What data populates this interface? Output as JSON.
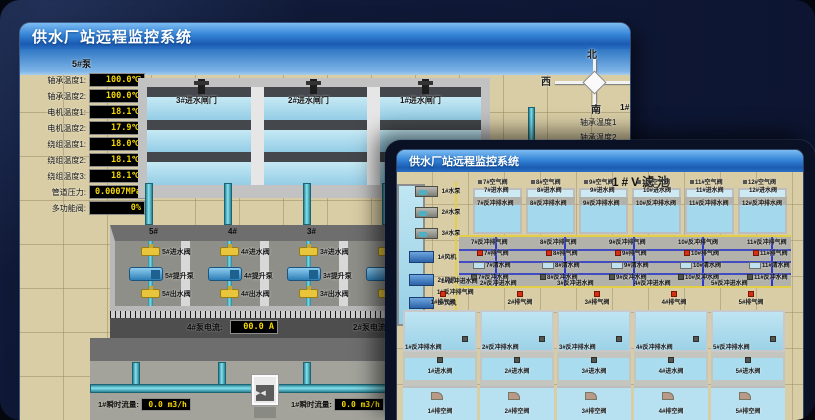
{
  "back": {
    "window_title": "供水厂站远程监控系统",
    "scene_title": "取水泵房",
    "panel_header": "5#泵",
    "sensors": [
      {
        "label": "轴承温度1:",
        "value": "100.0℃"
      },
      {
        "label": "轴承温度2:",
        "value": "100.0℃"
      },
      {
        "label": "电机温度1:",
        "value": "18.1℃"
      },
      {
        "label": "电机温度2:",
        "value": "17.9℃"
      },
      {
        "label": "绕组温度1:",
        "value": "18.0℃"
      },
      {
        "label": "绕组温度2:",
        "value": "18.1℃"
      },
      {
        "label": "绕组温度3:",
        "value": "18.1℃"
      },
      {
        "label": "管道压力:",
        "value": "0.0007MPa"
      },
      {
        "label": "多功能阀:",
        "value": "0%"
      }
    ],
    "gates": [
      "3#进水闸门",
      "2#进水闸门",
      "1#进水闸门"
    ],
    "compass": {
      "north": "北",
      "west": "西",
      "south": "南",
      "east": "东"
    },
    "right_panel": {
      "header": "1#泵",
      "rows": [
        "轴承温度1",
        "轴承温度2"
      ]
    },
    "bays": [
      {
        "no": "5#",
        "inlet": "5#进水阀",
        "pump": "5#提升泵",
        "outlet": "5#出水阀"
      },
      {
        "no": "4#",
        "inlet": "4#进水阀",
        "pump": "4#提升泵",
        "outlet": "4#出水阀"
      },
      {
        "no": "3#",
        "inlet": "3#进水阀",
        "pump": "3#提升泵",
        "outlet": "3#出水阀"
      },
      {
        "no": "2#",
        "inlet": "2#进水阀",
        "pump": "2#提升泵",
        "outlet": "2#出水阀"
      }
    ],
    "current_left": {
      "label": "4#泵电流:",
      "value": "00.0 A"
    },
    "current_right": {
      "label": "2#泵电流:"
    },
    "flows": [
      {
        "label": "1#瞬时流量:",
        "value": "0.0 m3/h"
      },
      {
        "label": "1#瞬时流量:",
        "value": "0.0 m3/h"
      }
    ]
  },
  "front": {
    "window_title": "供水厂站远程监控系统",
    "scene_title": "1#V滤池",
    "pumps": [
      "1#水泵",
      "2#水泵",
      "3#水泵"
    ],
    "fans": [
      "1#风机",
      "2#风机",
      "3#风机"
    ],
    "top_cells": [
      {
        "air": "7#空气阀",
        "inlet": "7#进水阀",
        "drain": "7#反冲排水阀"
      },
      {
        "air": "8#空气阀",
        "inlet": "8#进水阀",
        "drain": "8#反冲排水阀"
      },
      {
        "air": "9#空气阀",
        "inlet": "9#进水阀",
        "drain": "9#反冲排水阀"
      },
      {
        "air": "10#空气阀",
        "inlet": "10#进水阀",
        "drain": "10#反冲排水阀"
      },
      {
        "air": "11#空气阀",
        "inlet": "11#进水阀",
        "drain": "11#反冲排水阀"
      },
      {
        "air": "12#空气阀",
        "inlet": "12#进水阀",
        "drain": "12#反冲排水阀"
      }
    ],
    "gallery_cols": [
      {
        "bwvent": "7#反冲排气阀",
        "vent": "7#排气阀",
        "clean": "7#清水阀",
        "bwwater": "7#反冲水阀"
      },
      {
        "bwvent": "8#反冲排气阀",
        "vent": "8#排气阀",
        "clean": "8#清水阀",
        "bwwater": "8#反冲水阀"
      },
      {
        "bwvent": "9#反冲排气阀",
        "vent": "9#排气阀",
        "clean": "9#清水阀",
        "bwwater": "9#反冲水阀"
      },
      {
        "bwvent": "10#反冲排气阀",
        "vent": "10#排气阀",
        "clean": "10#清水阀",
        "bwwater": "10#反冲水阀"
      },
      {
        "bwvent": "11#反冲排气阀",
        "vent": "11#排气阀",
        "clean": "11#清水阀",
        "bwwater": "11#反冲水阀"
      }
    ],
    "left_labels": [
      "1#反冲进水阀",
      "1#反冲排气阀"
    ],
    "bw_inlets": [
      "2#反冲进水阀",
      "3#反冲进水阀",
      "4#反冲进水阀",
      "5#反冲进水阀"
    ],
    "bottom_vents": [
      "1#排气阀",
      "2#排气阀",
      "3#排气阀",
      "4#排气阀",
      "5#排气阀"
    ],
    "bottom_cells": [
      {
        "drain": "1#反冲排水阀",
        "inlet": "1#进水阀",
        "empty": "1#排空阀"
      },
      {
        "drain": "2#反冲排水阀",
        "inlet": "2#进水阀",
        "empty": "2#排空阀"
      },
      {
        "drain": "3#反冲排水阀",
        "inlet": "3#进水阀",
        "empty": "3#排空阀"
      },
      {
        "drain": "4#反冲排水阀",
        "inlet": "4#进水阀",
        "empty": "4#排空阀"
      },
      {
        "drain": "5#反冲排水阀",
        "inlet": "5#进水阀",
        "empty": "5#排空阀"
      }
    ]
  },
  "colors": {
    "titlebar_blue": "#2f7fd0",
    "background_navy": "#0d1430",
    "ground_tan": "#d9cda5",
    "water_blue": "#a9daee",
    "pipe_teal": "#5bc8d8",
    "valve_yellow": "#e8c53a",
    "pump_blue": "#4aa8e0",
    "vent_red": "#d43014",
    "led_text_yellow": "#f5d800",
    "led_bg_black": "#000000"
  }
}
